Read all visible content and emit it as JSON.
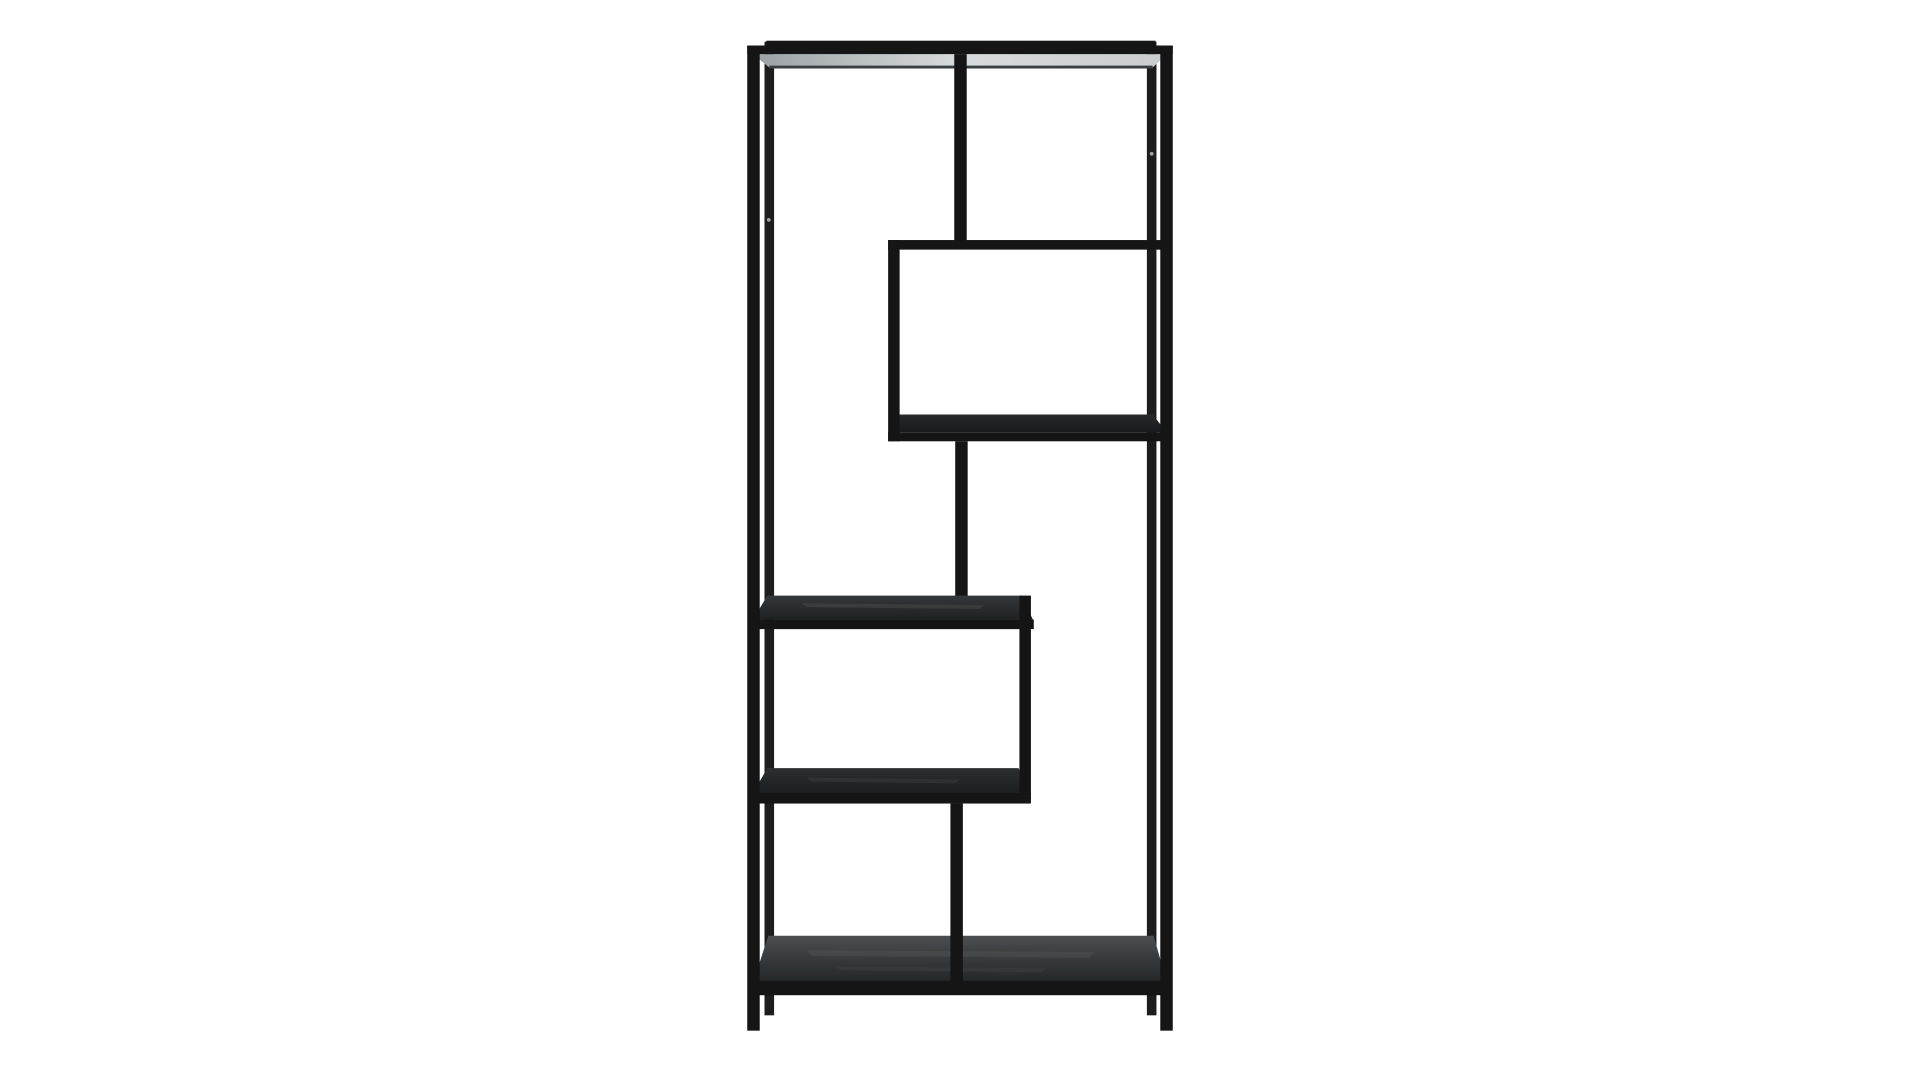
{
  "meta": {
    "type": "product-photo",
    "description": "Black metal asymmetric etagere bookcase with staggered shelves, photographed on a seamless white studio background"
  },
  "background_color": "#ffffff",
  "colors": {
    "frame": "#151515",
    "frameSoft": "#1d1d1d",
    "backEdge": "#3a3e40",
    "screw": "#9aa0a3",
    "grainLight": "#5a5f61",
    "grainMid": "#46494b"
  },
  "gradients": {
    "grad-top-underside": {
      "dir": "h",
      "stops": [
        "#9aa1a4",
        "#d8dbdc",
        "#c9cdce"
      ]
    },
    "grad-box-shelf": {
      "dir": "v",
      "stops": [
        "#27292b",
        "#17191a"
      ]
    },
    "grad-mid-shelf": {
      "dir": "v",
      "stops": [
        "#35383a",
        "#1e2021"
      ]
    },
    "grad-shelf4": {
      "dir": "v",
      "stops": [
        "#2c2f30",
        "#1c1e1f"
      ]
    },
    "grad-bottom-shelf": {
      "dir": "v",
      "stops": [
        "#4b4f51",
        "#232526"
      ]
    }
  },
  "furniture": {
    "name": "asymmetric-etagere-bookshelf",
    "viewbox": "0 0 1920 1080",
    "parts": [
      {
        "name": "back-left-post",
        "kind": "rect",
        "x": 756,
        "y": 20,
        "w": 10,
        "h": 1016,
        "color": "frameSoft"
      },
      {
        "name": "back-right-post",
        "kind": "rect",
        "x": 1155,
        "y": 20,
        "w": 10,
        "h": 1016,
        "color": "frameSoft"
      },
      {
        "name": "top-back-rail",
        "kind": "rect",
        "x": 758,
        "y": 19,
        "w": 406,
        "h": 8,
        "color": "frame"
      },
      {
        "name": "top-underside-panel",
        "kind": "poly",
        "points": [
          [
            744,
            33
          ],
          [
            1176,
            33
          ],
          [
            1161,
            47
          ],
          [
            761,
            47
          ]
        ],
        "gradient": "grad-top-underside"
      },
      {
        "name": "top-underside-back-edge",
        "kind": "rect",
        "x": 761,
        "y": 45,
        "w": 400,
        "h": 3,
        "color": "backEdge"
      },
      {
        "name": "top-front-rail",
        "kind": "rect",
        "x": 738,
        "y": 24,
        "w": 444,
        "h": 9,
        "color": "frame"
      },
      {
        "name": "upper-divider-bar",
        "kind": "rect",
        "x": 954,
        "y": 33,
        "w": 13,
        "h": 200,
        "color": "frame"
      },
      {
        "name": "upper-box-top-rail",
        "kind": "rect",
        "x": 885,
        "y": 227,
        "w": 291,
        "h": 10,
        "color": "frame"
      },
      {
        "name": "upper-box-shelf-surface",
        "kind": "poly",
        "points": [
          [
            897,
            409
          ],
          [
            1161,
            409
          ],
          [
            1176,
            428
          ],
          [
            885,
            428
          ]
        ],
        "gradient": "grad-box-shelf"
      },
      {
        "name": "upper-box-left-post",
        "kind": "rect",
        "x": 885,
        "y": 227,
        "w": 12,
        "h": 210,
        "color": "frame"
      },
      {
        "name": "upper-box-shelf-front-rail",
        "kind": "rect",
        "x": 885,
        "y": 428,
        "w": 291,
        "h": 9,
        "color": "frame"
      },
      {
        "name": "middle-divider-bar",
        "kind": "rect",
        "x": 955,
        "y": 437,
        "w": 13,
        "h": 166,
        "color": "frame"
      },
      {
        "name": "middle-shelf-surface",
        "kind": "poly",
        "points": [
          [
            759,
            598
          ],
          [
            1024,
            598
          ],
          [
            1036,
            623
          ],
          [
            744,
            623
          ]
        ],
        "gradient": "grad-mid-shelf"
      },
      {
        "name": "middle-shelf-grain-streak",
        "kind": "poly",
        "points": [
          [
            795,
            606
          ],
          [
            985,
            608
          ],
          [
            980,
            612
          ],
          [
            800,
            610
          ]
        ],
        "color": "grainLight",
        "opacity": 0.3
      },
      {
        "name": "middle-shelf-front-rail",
        "kind": "rect",
        "x": 744,
        "y": 623,
        "w": 293,
        "h": 10,
        "color": "frame"
      },
      {
        "name": "shelf4-surface",
        "kind": "poly",
        "points": [
          [
            759,
            778
          ],
          [
            1021,
            778
          ],
          [
            1033,
            804
          ],
          [
            744,
            804
          ]
        ],
        "gradient": "grad-shelf4"
      },
      {
        "name": "shelf4-grain-streak",
        "kind": "poly",
        "points": [
          [
            800,
            788
          ],
          [
            960,
            790
          ],
          [
            955,
            794
          ],
          [
            805,
            792
          ]
        ],
        "color": "grainMid",
        "opacity": 0.35
      },
      {
        "name": "lower-box-right-post",
        "kind": "rect",
        "x": 1022,
        "y": 598,
        "w": 12,
        "h": 212,
        "color": "frame"
      },
      {
        "name": "shelf4-front-rail",
        "kind": "rect",
        "x": 744,
        "y": 804,
        "w": 290,
        "h": 11,
        "color": "frame"
      },
      {
        "name": "bottom-shelf-surface",
        "kind": "poly",
        "points": [
          [
            760,
            953
          ],
          [
            1162,
            953
          ],
          [
            1176,
            1002
          ],
          [
            744,
            1002
          ]
        ],
        "gradient": "grad-bottom-shelf"
      },
      {
        "name": "bottom-shelf-grain-streak",
        "kind": "poly",
        "points": [
          [
            800,
            968
          ],
          [
            1100,
            970
          ],
          [
            1094,
            976
          ],
          [
            806,
            974
          ]
        ],
        "color": "grainLight",
        "opacity": 0.3
      },
      {
        "name": "bottom-shelf-grain-streak",
        "kind": "poly",
        "points": [
          [
            830,
            985
          ],
          [
            1050,
            987
          ],
          [
            1045,
            991
          ],
          [
            836,
            989
          ]
        ],
        "color": "grainMid",
        "opacity": 0.35
      },
      {
        "name": "lower-divider-bar",
        "kind": "rect",
        "x": 950,
        "y": 815,
        "w": 13,
        "h": 193,
        "color": "frame"
      },
      {
        "name": "bottom-shelf-front-rail",
        "kind": "rect",
        "x": 744,
        "y": 1000,
        "w": 432,
        "h": 15,
        "color": "frame"
      },
      {
        "name": "front-left-post",
        "kind": "rect",
        "x": 738,
        "y": 24,
        "w": 13,
        "h": 1028,
        "color": "frame"
      },
      {
        "name": "front-right-post",
        "kind": "rect",
        "x": 1169,
        "y": 24,
        "w": 13,
        "h": 1028,
        "color": "frame"
      },
      {
        "name": "screw-dot",
        "kind": "circle",
        "cx": 760.5,
        "cy": 206,
        "r": 2,
        "color": "screw"
      },
      {
        "name": "screw-dot",
        "kind": "circle",
        "cx": 1160,
        "cy": 137,
        "r": 2,
        "color": "screw"
      }
    ]
  }
}
